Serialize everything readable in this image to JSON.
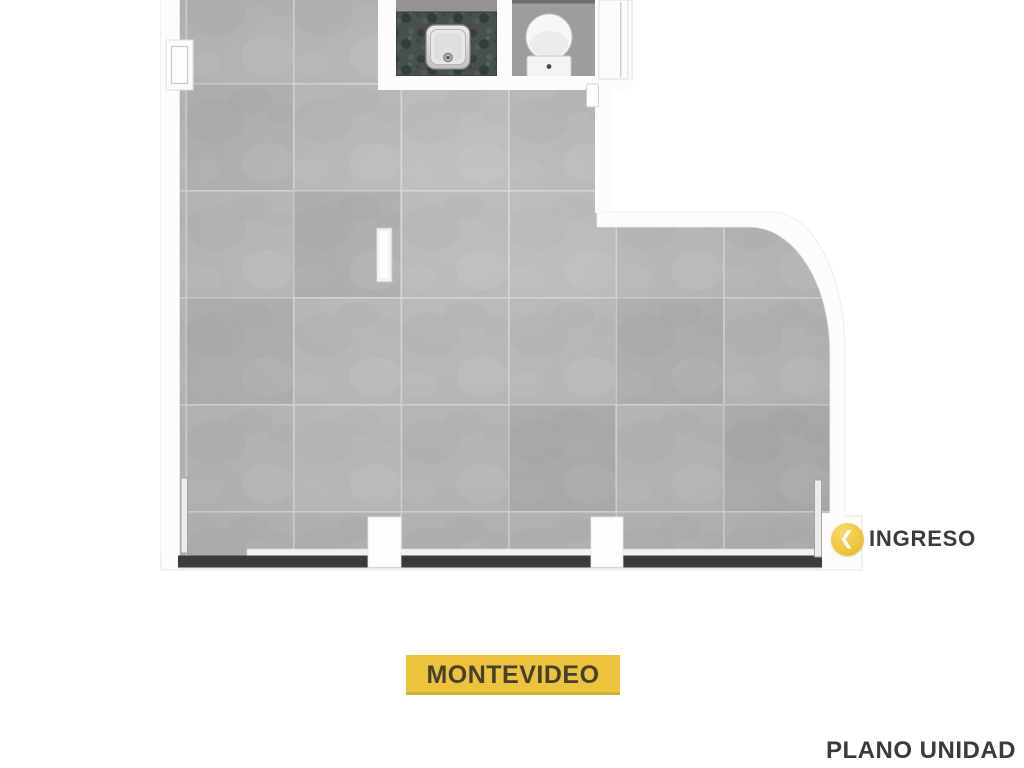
{
  "plan": {
    "entrance_label": "INGRESO",
    "street_label": "MONTEVIDEO",
    "caption": "PLANO UNIDAD"
  },
  "icons": {
    "entrance_chevron": "❮"
  },
  "colors": {
    "accent_yellow": "#EDC33D",
    "banner_text": "#47402F",
    "label_text": "#3B3B3B",
    "glass_band": "#3A3A3A",
    "floor_tile": "#B6B6B6"
  }
}
